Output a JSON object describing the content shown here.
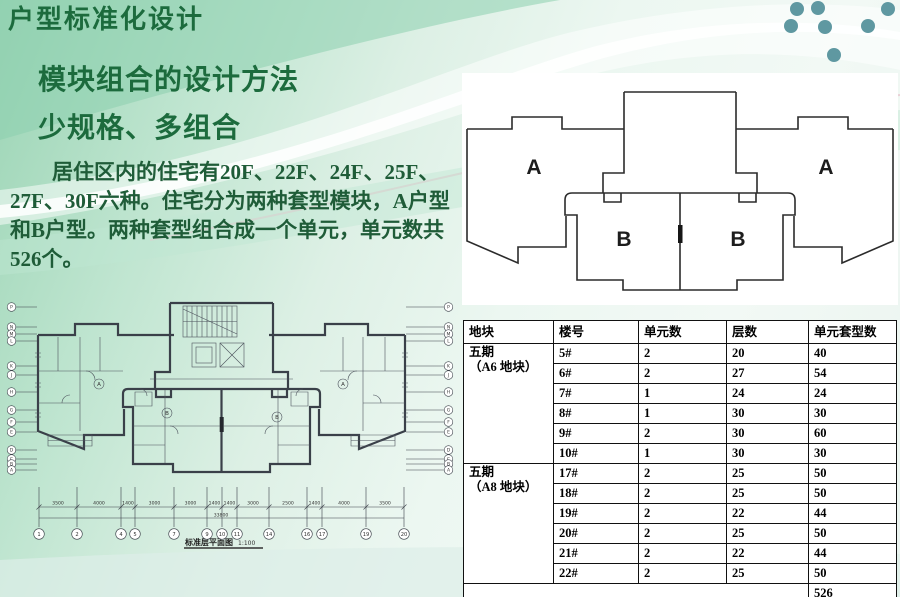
{
  "slide": {
    "title": "户型标准化设计",
    "subtitle_method": "模块组合的设计方法",
    "subtitle_motto": "少规格、多组合",
    "body_text": "居住区内的住宅有20F、22F、24F、25F、27F、30F六种。住宅分为两种套型模块，A户型和B户型。两种套型组合成一个单元，单元数共526个。",
    "colors": {
      "accent_green": "#1c6b3d",
      "body_green": "#1f5c38",
      "dot_teal": "#5f98a1",
      "line_dark": "#2b2b2b"
    }
  },
  "unit_diagram": {
    "label_a_left": "A",
    "label_a_right": "A",
    "label_b_left": "B",
    "label_b_right": "B"
  },
  "floor_plan": {
    "caption": "标准层平面图",
    "scale": "1:100",
    "unit_marker_a": "A",
    "unit_marker_b": "B",
    "grid_letters": [
      "P",
      "N",
      "M",
      "L",
      "K",
      "J",
      "H",
      "G",
      "F",
      "E",
      "D",
      "C",
      "B",
      "A"
    ],
    "grid_numbers": [
      "1",
      "2",
      "4",
      "5",
      "7",
      "9",
      "10",
      "11",
      "14",
      "16",
      "17",
      "19",
      "20"
    ],
    "dim_segments": [
      "3500",
      "4000",
      "1400",
      "3000",
      "3000",
      "1400",
      "1400",
      "3000",
      "2500",
      "1400",
      "4000",
      "3500"
    ],
    "dim_total": "33800"
  },
  "table": {
    "headers": [
      "地块",
      "楼号",
      "单元数",
      "层数",
      "单元套型数"
    ],
    "groups": [
      {
        "block": "五期",
        "block_sub": "（A6 地块）",
        "rows": [
          [
            "5#",
            "2",
            "20",
            "40"
          ],
          [
            "6#",
            "2",
            "27",
            "54"
          ],
          [
            "7#",
            "1",
            "24",
            "24"
          ],
          [
            "8#",
            "1",
            "30",
            "30"
          ],
          [
            "9#",
            "2",
            "30",
            "60"
          ],
          [
            "10#",
            "1",
            "30",
            "30"
          ]
        ]
      },
      {
        "block": "五期",
        "block_sub": "（A8 地块）",
        "rows": [
          [
            "17#",
            "2",
            "25",
            "50"
          ],
          [
            "18#",
            "2",
            "25",
            "50"
          ],
          [
            "19#",
            "2",
            "22",
            "44"
          ],
          [
            "20#",
            "2",
            "25",
            "50"
          ],
          [
            "21#",
            "2",
            "22",
            "44"
          ],
          [
            "22#",
            "2",
            "25",
            "50"
          ]
        ]
      }
    ],
    "total_label": "526"
  }
}
